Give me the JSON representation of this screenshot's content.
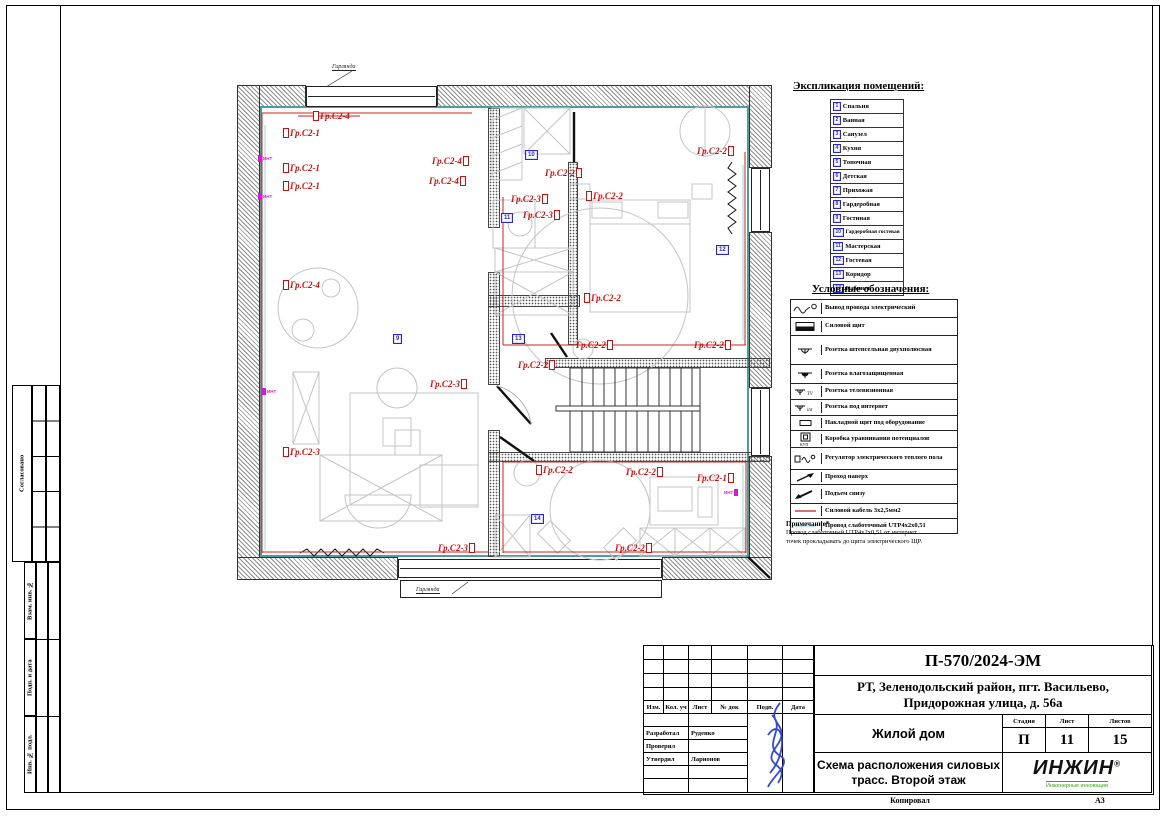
{
  "page": {
    "footer_copy": "Копировал",
    "footer_format": "А3"
  },
  "side": {
    "approved": "Согласовано",
    "zam": "Взам. инв. №",
    "podp": "Подп. и дата",
    "inv": "Инв. № подл."
  },
  "plan": {
    "garland_top": "Гирлянда",
    "garland_bottom": "Гирлянда",
    "int_label": "ИНТ",
    "labels": [
      {
        "text": "Гр.С2-4"
      },
      {
        "text": "Гр.С2-1"
      },
      {
        "text": "Гр.С2-1"
      },
      {
        "text": "Гр.С2-1"
      },
      {
        "text": "Гр.С2-4"
      },
      {
        "text": "Гр.С2-4"
      },
      {
        "text": "Гр.С2-4"
      },
      {
        "text": "Гр.С2-2"
      },
      {
        "text": "Гр.С2-3"
      },
      {
        "text": "Гр.С2-2"
      },
      {
        "text": "Гр.С2-3"
      },
      {
        "text": "Гр.С2-2"
      },
      {
        "text": "Гр.С2-2"
      },
      {
        "text": "Гр.С2-2"
      },
      {
        "text": "Гр.С2-2"
      },
      {
        "text": "Гр.С2-2"
      },
      {
        "text": "Гр.С2-3"
      },
      {
        "text": "Гр.С2-3"
      },
      {
        "text": "Гр.С2-2"
      },
      {
        "text": "Гр.С2-2"
      },
      {
        "text": "Гр.С2-1"
      },
      {
        "text": "Гр.С2-3"
      },
      {
        "text": "Гр.С2-2"
      }
    ],
    "badges": [
      {
        "num": "9"
      },
      {
        "num": "10"
      },
      {
        "num": "11"
      },
      {
        "num": "12"
      },
      {
        "num": "13"
      },
      {
        "num": "14"
      }
    ]
  },
  "explication": {
    "title": "Экспликация помещений:",
    "rows": [
      {
        "num": "1",
        "name": "Спальня"
      },
      {
        "num": "2",
        "name": "Ванная"
      },
      {
        "num": "3",
        "name": "Санузел"
      },
      {
        "num": "4",
        "name": "Кухня"
      },
      {
        "num": "5",
        "name": "Топочная"
      },
      {
        "num": "6",
        "name": "Детская"
      },
      {
        "num": "7",
        "name": "Прихожая"
      },
      {
        "num": "8",
        "name": "Гардеробная"
      },
      {
        "num": "9",
        "name": "Гостиная"
      },
      {
        "num": "10",
        "name": "Гардеробная гостевая"
      },
      {
        "num": "11",
        "name": "Мастерская"
      },
      {
        "num": "12",
        "name": "Гостевая"
      },
      {
        "num": "13",
        "name": "Коридор"
      },
      {
        "num": "14",
        "name": "Кабинет"
      }
    ]
  },
  "legend": {
    "title": "Условные обозначения:",
    "rows": [
      {
        "name": "Вывод провода электрический"
      },
      {
        "name": "Силовой щит"
      },
      {
        "name": "Розетка штепсельная двухполюсная"
      },
      {
        "name": "Розетка влагозащищенная"
      },
      {
        "name": "Розетка телевизионная"
      },
      {
        "name": "Розетка под интернет"
      },
      {
        "name": "Накладной щит под оборудование"
      },
      {
        "name": "Коробка уравнивания потенциалов"
      },
      {
        "name": "Регулятор электрического теплого пола"
      },
      {
        "name": "Проход наверх"
      },
      {
        "name": "Подъем снизу"
      },
      {
        "name": "Силовой кабель 3х2,5мм2"
      },
      {
        "name": "Провод слаботочный UTP4х2х0,51"
      }
    ]
  },
  "note": {
    "title": "Примечание*",
    "line1": "Провод слаботочный UTP4х2х0,51 от интернет",
    "line2": "точек прокладывать до щита электрического ЩР."
  },
  "titleblock": {
    "doc_no": "П-570/2024-ЭМ",
    "address_line1": "РТ, Зеленодольский район, пгт. Васильево,",
    "address_line2": "Придорожная улица, д. 56а",
    "object": "Жилой дом",
    "sheet_name_line1": "Схема расположения силовых",
    "sheet_name_line2": "трасс. Второй этаж",
    "cols": {
      "izm": "Изм.",
      "kol": "Кол. уч",
      "list": "Лист",
      "doc": "№ док",
      "sign": "Подп.",
      "date": "Дата"
    },
    "stage_label": "Стадия",
    "sheet_label": "Лист",
    "sheets_label": "Листов",
    "stage": "П",
    "sheet": "11",
    "sheets": "15",
    "roles": [
      {
        "role": "Разработал",
        "name": "Руденко"
      },
      {
        "role": "Проверил",
        "name": ""
      },
      {
        "role": "Утвердил",
        "name": "Ларионов"
      }
    ],
    "logo": {
      "name": "ИНЖИН",
      "reg": "®",
      "tagline": "Инженерные инновации"
    }
  },
  "colors": {
    "accent_red": "#cf0f0f",
    "badge_blue": "#2a2ac0",
    "magenta": "#d619d6",
    "teal": "#4f9c9c",
    "cyan_wire": "#a8dce8",
    "logo_green": "#3aa517"
  }
}
